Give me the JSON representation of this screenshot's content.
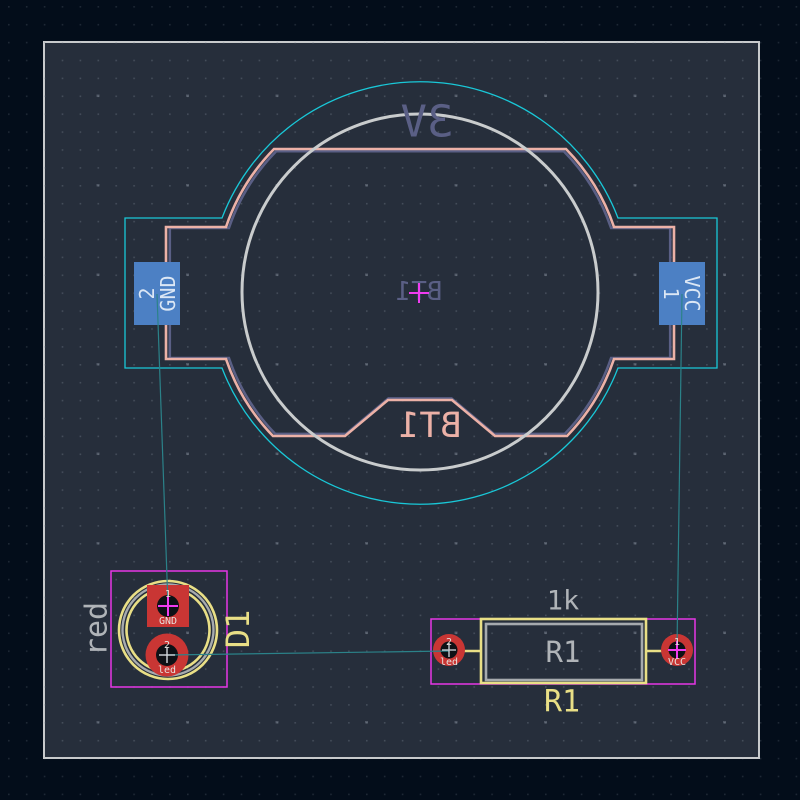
{
  "editor": {
    "view": "pcb-layout-canvas",
    "board_present": true
  },
  "colors": {
    "canvas_background": "#030d1a",
    "board_fill": "#262e3b",
    "board_edge": "#c8cacc",
    "front_silkscreen": "#e9df86",
    "back_silkscreen": "#ecb1a7",
    "front_fab": "#b0b4b8",
    "back_fab": "#5a5f85",
    "front_copper_pad": "#c93634",
    "back_copper_pad": "#4c80c4",
    "front_courtyard": "#e636e6",
    "back_courtyard": "#19c8d8",
    "ratsnest": "#2b8289",
    "anchor_cross": "#f03cf0",
    "hole": "#0e1116"
  },
  "battery": {
    "reference_fab": "BT1",
    "reference_silk": "BT1",
    "value": "3V",
    "pad_gnd": {
      "number": "2",
      "net": "GND"
    },
    "pad_vcc": {
      "number": "1",
      "net": "VCC"
    }
  },
  "led": {
    "reference": "D1",
    "value": "red",
    "pad1": {
      "number": "1",
      "net": "GND"
    },
    "pad2": {
      "number": "2",
      "net": "led"
    }
  },
  "resistor": {
    "reference_silk": "R1",
    "reference_fab": "R1",
    "value": "1k",
    "pad1": {
      "number": "1",
      "net": "VCC"
    },
    "pad2": {
      "number": "2",
      "net": "led"
    }
  }
}
